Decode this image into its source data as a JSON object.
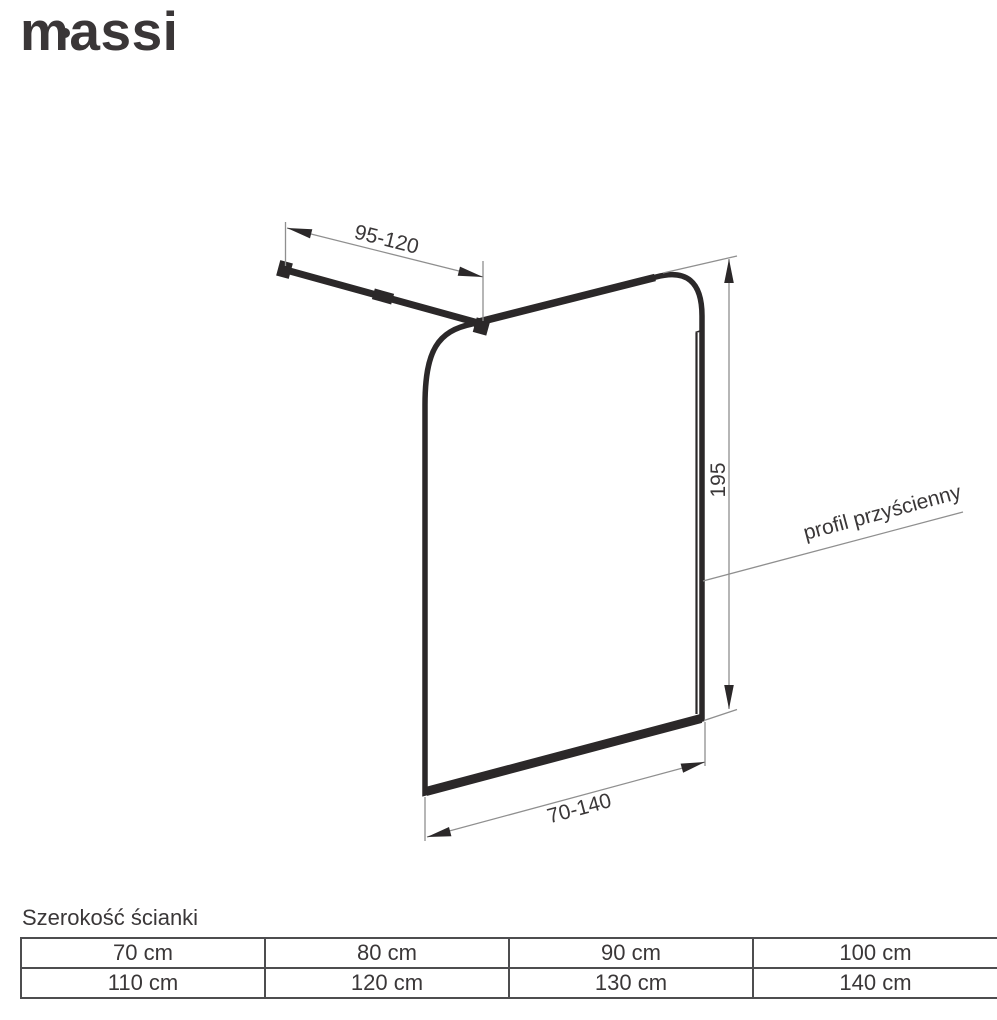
{
  "brand": {
    "name": "massi"
  },
  "diagram": {
    "arm_range_label": "95-120",
    "height_label": "195",
    "width_range_label": "70-140",
    "wall_profile_label": "profil przyścienny"
  },
  "size_table": {
    "title": "Szerokość ścianki",
    "rows": [
      [
        "70 cm",
        "80 cm",
        "90 cm",
        "100 cm"
      ],
      [
        "110 cm",
        "120 cm",
        "130 cm",
        "140 cm"
      ]
    ]
  },
  "colors": {
    "ink": "#2b2829",
    "dimension_line": "#8f8f8f",
    "text": "#3a3738",
    "table_border": "#4d4d4f",
    "background": "#ffffff"
  }
}
